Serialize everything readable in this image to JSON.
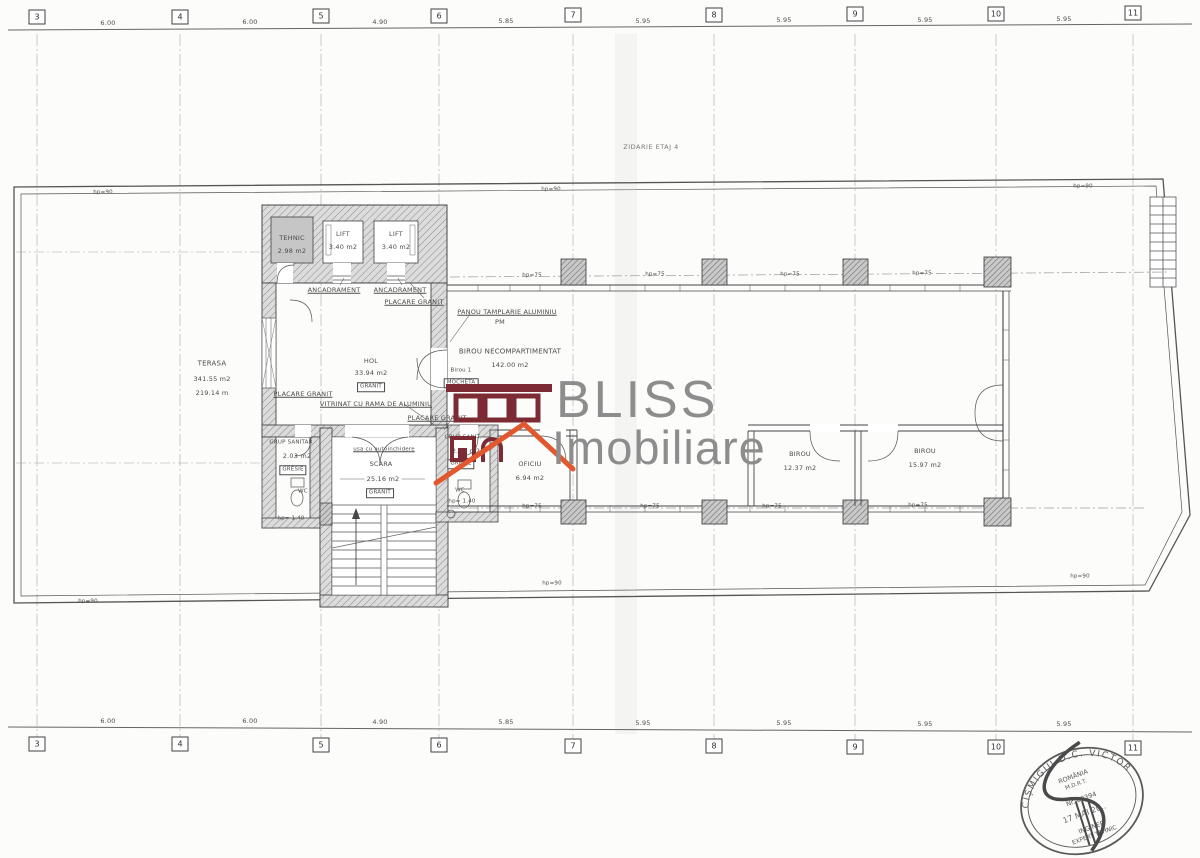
{
  "drawing": {
    "grid_columns": [
      "3",
      "4",
      "5",
      "6",
      "7",
      "8",
      "9",
      "10",
      "11"
    ],
    "grid_dims": [
      "6.00",
      "6.00",
      "4.90",
      "5.85",
      "5.95",
      "5.95",
      "5.95",
      "5.95"
    ],
    "note_zidarie": "ZIDARIE ETAJ 4",
    "hp90": "hp=90",
    "hp75": "hp=75",
    "rooms": {
      "tehnic_name": "TEHNIC",
      "tehnic_area": "2.98 m2",
      "lift_name": "LIFT",
      "lift_area": "3.40 m2",
      "hol_name": "HOL",
      "hol_area": "33.94 m2",
      "hol_finish": "GRANIT",
      "open_office_name": "BIROU NECOMPARTIMENTAT",
      "open_office_area": "142.00 m2",
      "birou1_name": "Birou 1",
      "birou1_finish": "MOCHETA",
      "terasa_name": "TERASA",
      "terasa_area": "341.55 m2",
      "terasa_area2": "219.14 m",
      "gs1_name": "GRUP SANITAR",
      "gs1_area": "2.03 m2",
      "gs_finish": "GRESIE",
      "gs2_name": "GRUP SANIT.",
      "gs2_area": "2.03 m2",
      "wc": "WC",
      "wc_hp": "hp= 1.40",
      "scara_name": "SCARA",
      "scara_area": "25.16 m2",
      "scara_finish": "GRANIT",
      "scara_door": "usa cu autoinchidere",
      "oficiu_name": "OFICIU",
      "oficiu_area": "6.94 m2",
      "birou2_name": "BIROU",
      "birou2_area": "12.37 m2",
      "birou3_name": "BIROU",
      "birou3_area": "15.97 m2"
    },
    "callouts": {
      "ancadrament": "ANCADRAMENT",
      "placare_granit": "PLACARE GRANIT",
      "vitrinat": "VITRINAT CU RAMA DE ALUMINIU",
      "panou_line1": "PANOU TAMPLARIE ALUMINIU",
      "panou_line2": "PM"
    }
  },
  "watermark": {
    "line1": "BLISS",
    "line2": "Imobiliare",
    "text_color": "#8d8d8d",
    "logo_maroon": "#7c2b34",
    "logo_orange": "#e2582e"
  },
  "stamp": {
    "ring_name": "CIȘMIGIU D.C. VICTOR",
    "country": "ROMÂNIA",
    "org": "M.D.R.T.",
    "reg_no": "Nr. 08394",
    "date": "17 MAI 20..",
    "title1": "INGINER",
    "title2": "EXPERT TEHNIC"
  }
}
